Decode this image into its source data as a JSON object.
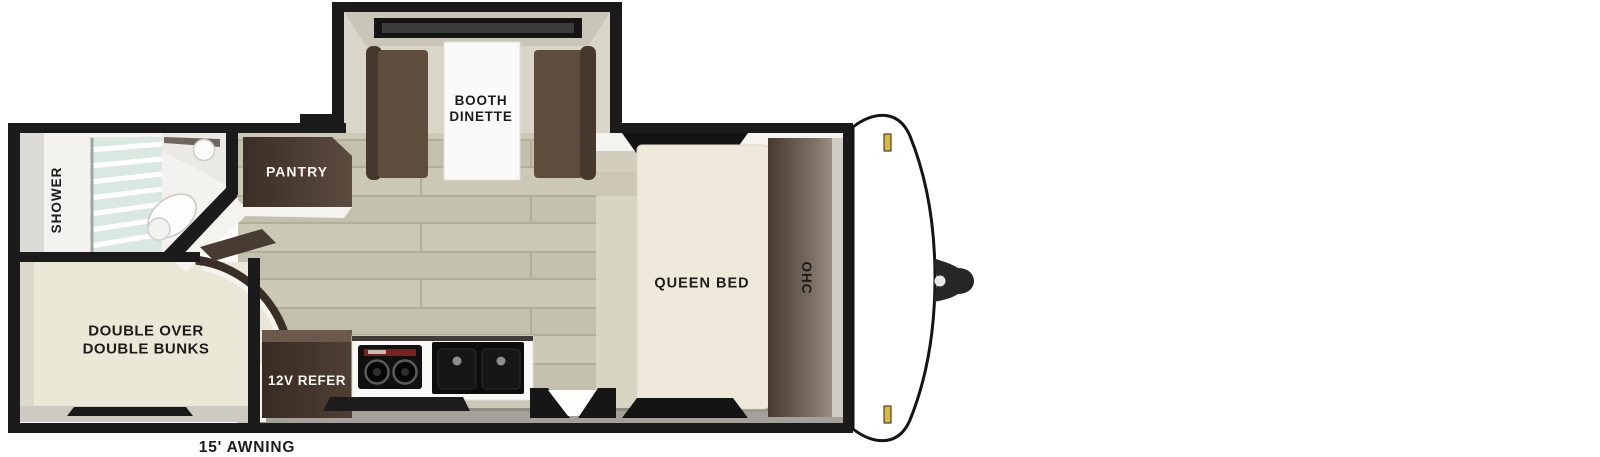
{
  "diagram": {
    "type": "travel-trailer-floorplan",
    "orientation": "hitch-on-right"
  },
  "labels": {
    "booth_dinette": "BOOTH DINETTE",
    "pantry": "PANTRY",
    "shower": "SHOWER",
    "queen_bed": "QUEEN BED",
    "ohc": "OHC",
    "refrigerator": "12V REFER",
    "bunks": "DOUBLE OVER DOUBLE BUNKS",
    "awning": "15' AWNING"
  },
  "colors": {
    "wall": "#1b1b1b",
    "floor_plank": "#c8c5b2",
    "cream_room": "#ece8d8",
    "cabinet_dark_brown": "#42352c",
    "bench_brown": "#5e4c3d",
    "counter_white": "#f8f8f6",
    "marker_light_amber": "#ddb83c",
    "cooktop_red": "#7d2020",
    "shower_glass": "#d9e8e0"
  }
}
